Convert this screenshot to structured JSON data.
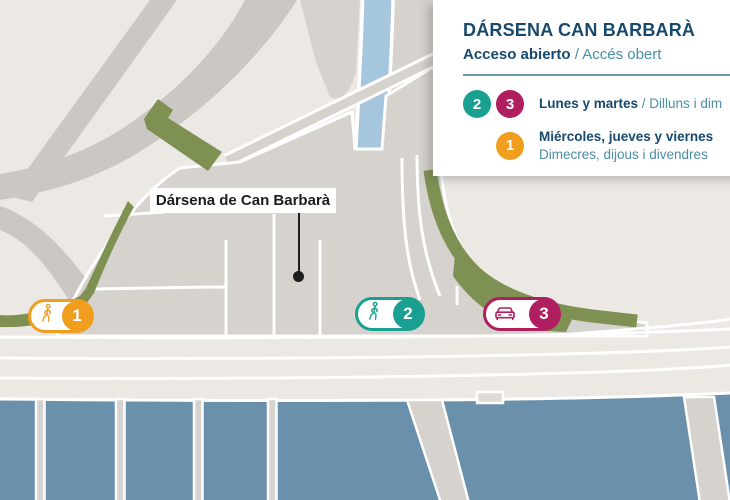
{
  "legend": {
    "title": "DÁRSENA CAN BARBARÀ",
    "subtitle_es": "Acceso abierto",
    "subtitle_ca": " / Accés obert",
    "rows": [
      {
        "badges": [
          {
            "num": "2"
          },
          {
            "num": "3"
          }
        ],
        "label_es": "Lunes y martes",
        "label_ca": " / Dilluns i dim"
      },
      {
        "badges": [
          {
            "num": "1"
          }
        ],
        "label_es": "Miércoles, jueves y viernes",
        "label_ca": "Dimecres, dijous i divendres"
      }
    ]
  },
  "map": {
    "place_label": "Dársena de Can Barbarà",
    "markers": [
      {
        "num": "1",
        "icon": "pedestrian-icon"
      },
      {
        "num": "2",
        "icon": "pedestrian-icon"
      },
      {
        "num": "3",
        "icon": "car-icon"
      }
    ]
  },
  "colors": {
    "navy": "#17496d",
    "teal": "#1aa091",
    "teal_text": "#4a8fa4",
    "rule": "#6f9aa9",
    "magenta": "#b01e60",
    "orange": "#f19e1f",
    "green": "#7e9152",
    "water": "#6b90ac",
    "canal": "#a6c6de",
    "land_light": "#ece9e5",
    "land_gray": "#d6d2cd",
    "road_gray": "#cbc7c2",
    "ink": "#1d1d1b"
  }
}
